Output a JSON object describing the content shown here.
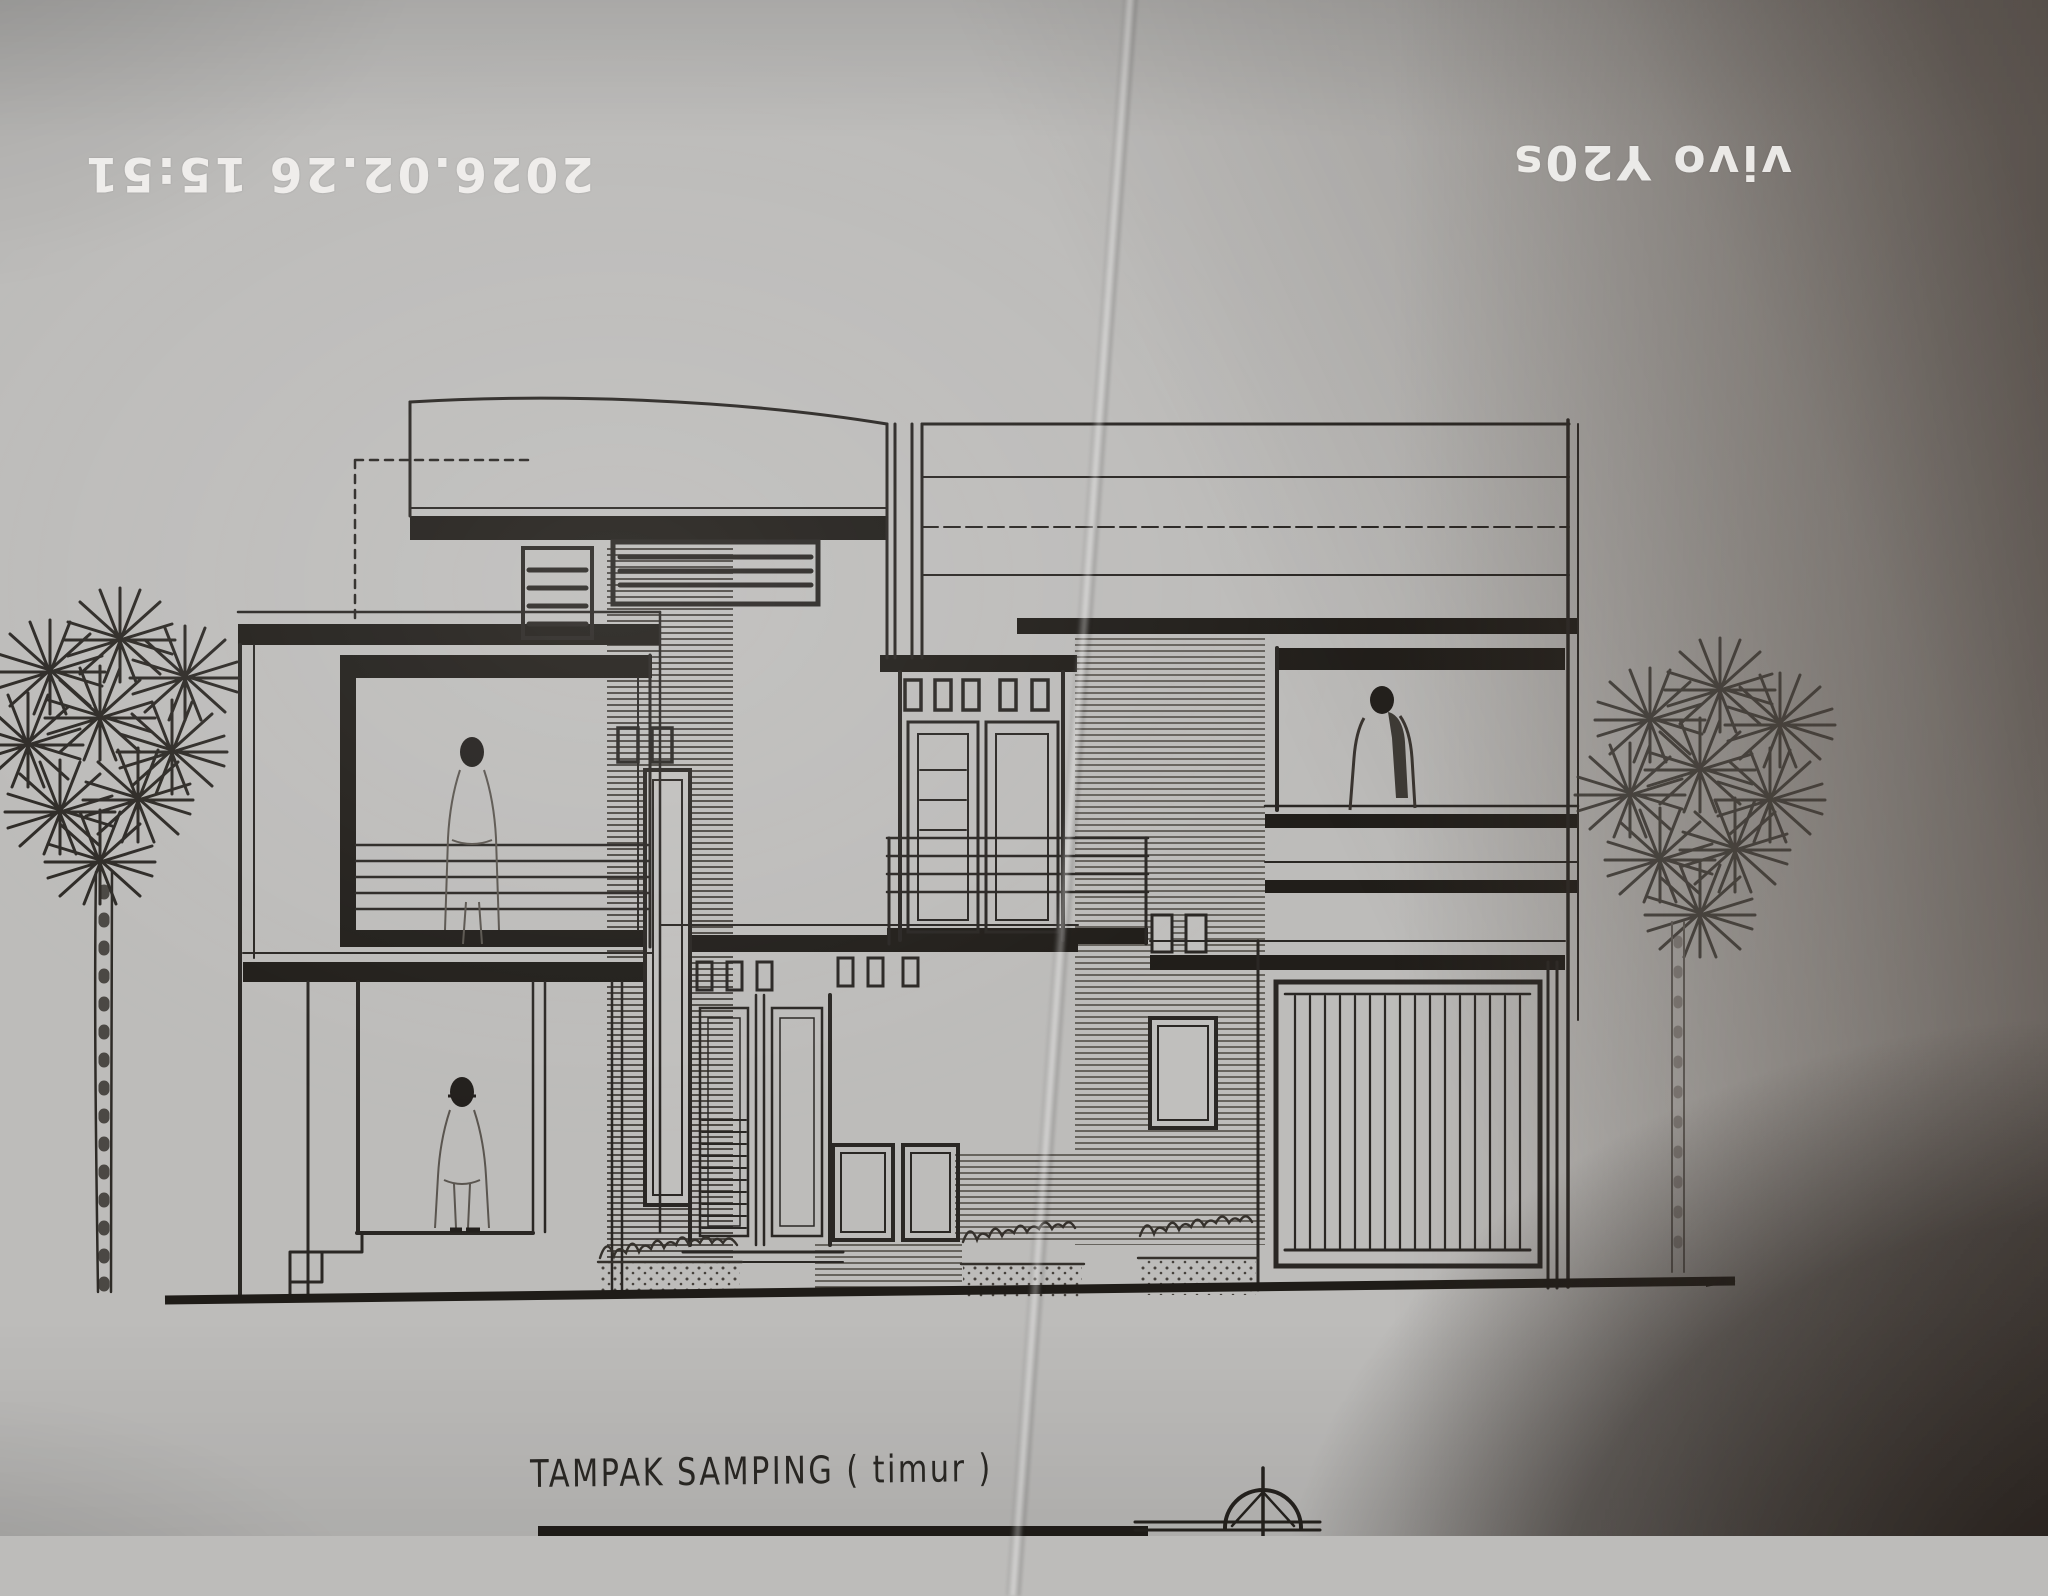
{
  "photo": {
    "timestamp": "2026.02.26 15:51",
    "watermark": "vivo Y20s"
  },
  "colors": {
    "paper": "#bdbcba",
    "ink": "#2a2724",
    "shadow": "#2e2722",
    "stamp_text": "#f2f1ef"
  },
  "drawing": {
    "caption": "TAMPAK SAMPING ( timur )",
    "elements": [
      "two-story-house-side-elevation",
      "left-palm-tree",
      "right-palm-tree",
      "person-on-left-balcony",
      "person-at-ground-floor",
      "person-on-right-balcony",
      "roof-louver-vents",
      "double-doors-with-transom-vents",
      "garage-door-vertical-slats",
      "brick-hatched-pier",
      "planter-shrubs",
      "ground-line",
      "north-dome-symbol",
      "paper-fold-crease"
    ]
  }
}
